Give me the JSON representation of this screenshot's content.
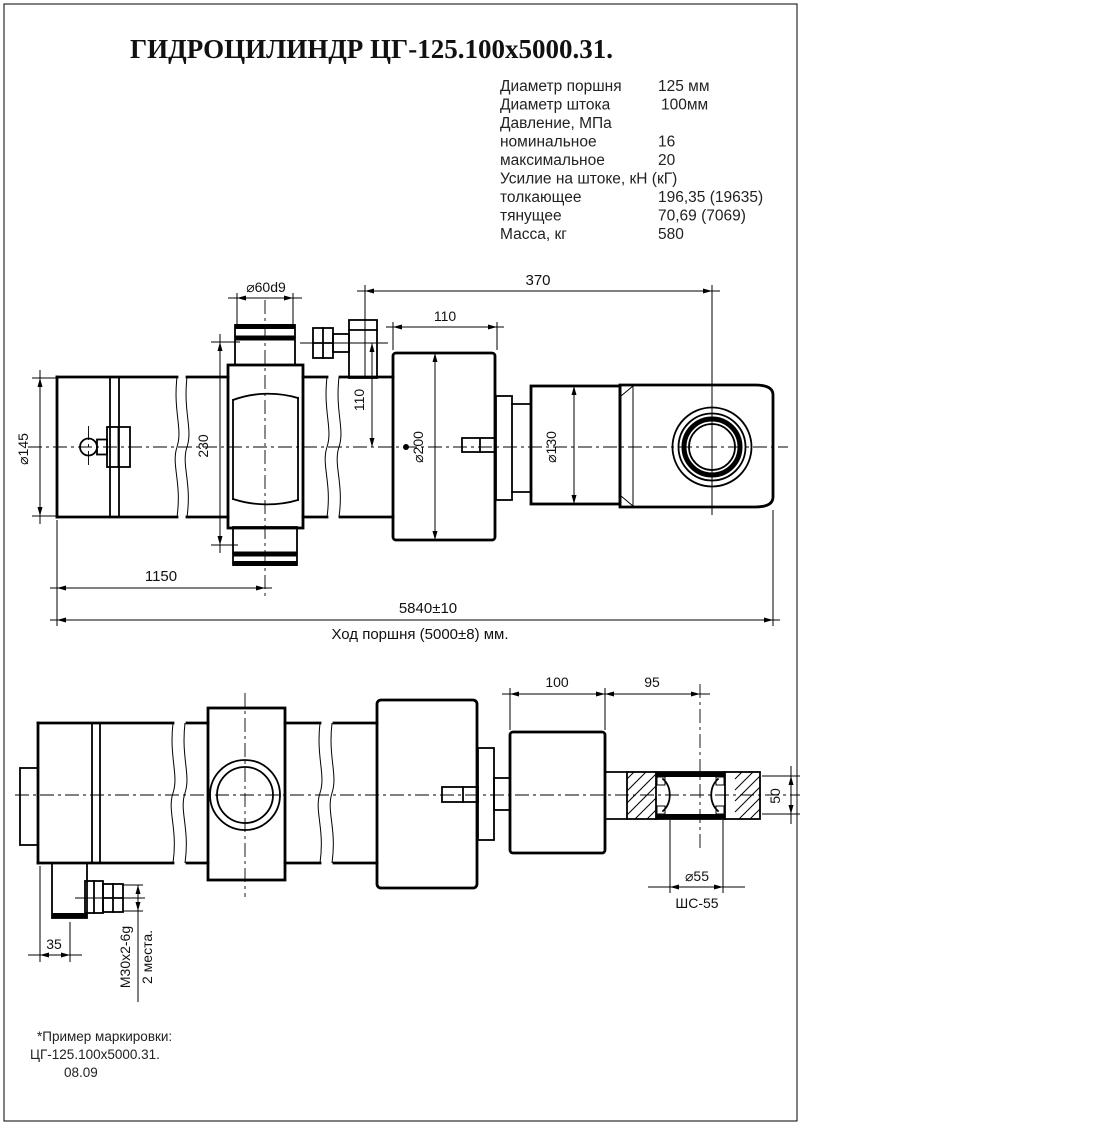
{
  "title": "ГИДРОЦИЛИНДР ЦГ-125.100х5000.31.",
  "specs": {
    "rows": [
      {
        "label": "Диаметр поршня",
        "value": "125 мм"
      },
      {
        "label": "Диаметр штока",
        "value": "100мм"
      },
      {
        "label": "Давление, МПа",
        "value": ""
      },
      {
        "label": "номинальное",
        "value": "16"
      },
      {
        "label": "максимальное",
        "value": "20"
      },
      {
        "label": "Усилие на штоке, кН (кГ)",
        "value": ""
      },
      {
        "label": "толкающее",
        "value": "196,35 (19635)"
      },
      {
        "label": "тянущее",
        "value": "70,69 (7069)"
      },
      {
        "label": "Масса, кг",
        "value": "580"
      }
    ]
  },
  "top_view": {
    "phi60d9": "⌀60d9",
    "len370": "370",
    "len110_top": "110",
    "len110_side": "110",
    "phi200": "⌀200",
    "phi130": "⌀130",
    "phi145": "⌀145",
    "len230": "230",
    "len1150": "1150",
    "len5840": "5840±10",
    "stroke_note": "Ход поршня (5000±8) мм."
  },
  "bottom_view": {
    "len100": "100",
    "len95": "95",
    "len50": "50",
    "phi55": "⌀55",
    "bearing": "ШС-55",
    "len35": "35",
    "thread": "М30х2-6g",
    "places": "2 места."
  },
  "footer": {
    "line1": "*Пример маркировки:",
    "line2": "ЦГ-125.100х5000.31.",
    "line3": "08.09"
  },
  "colors": {
    "line": "#000000",
    "background": "#ffffff"
  }
}
